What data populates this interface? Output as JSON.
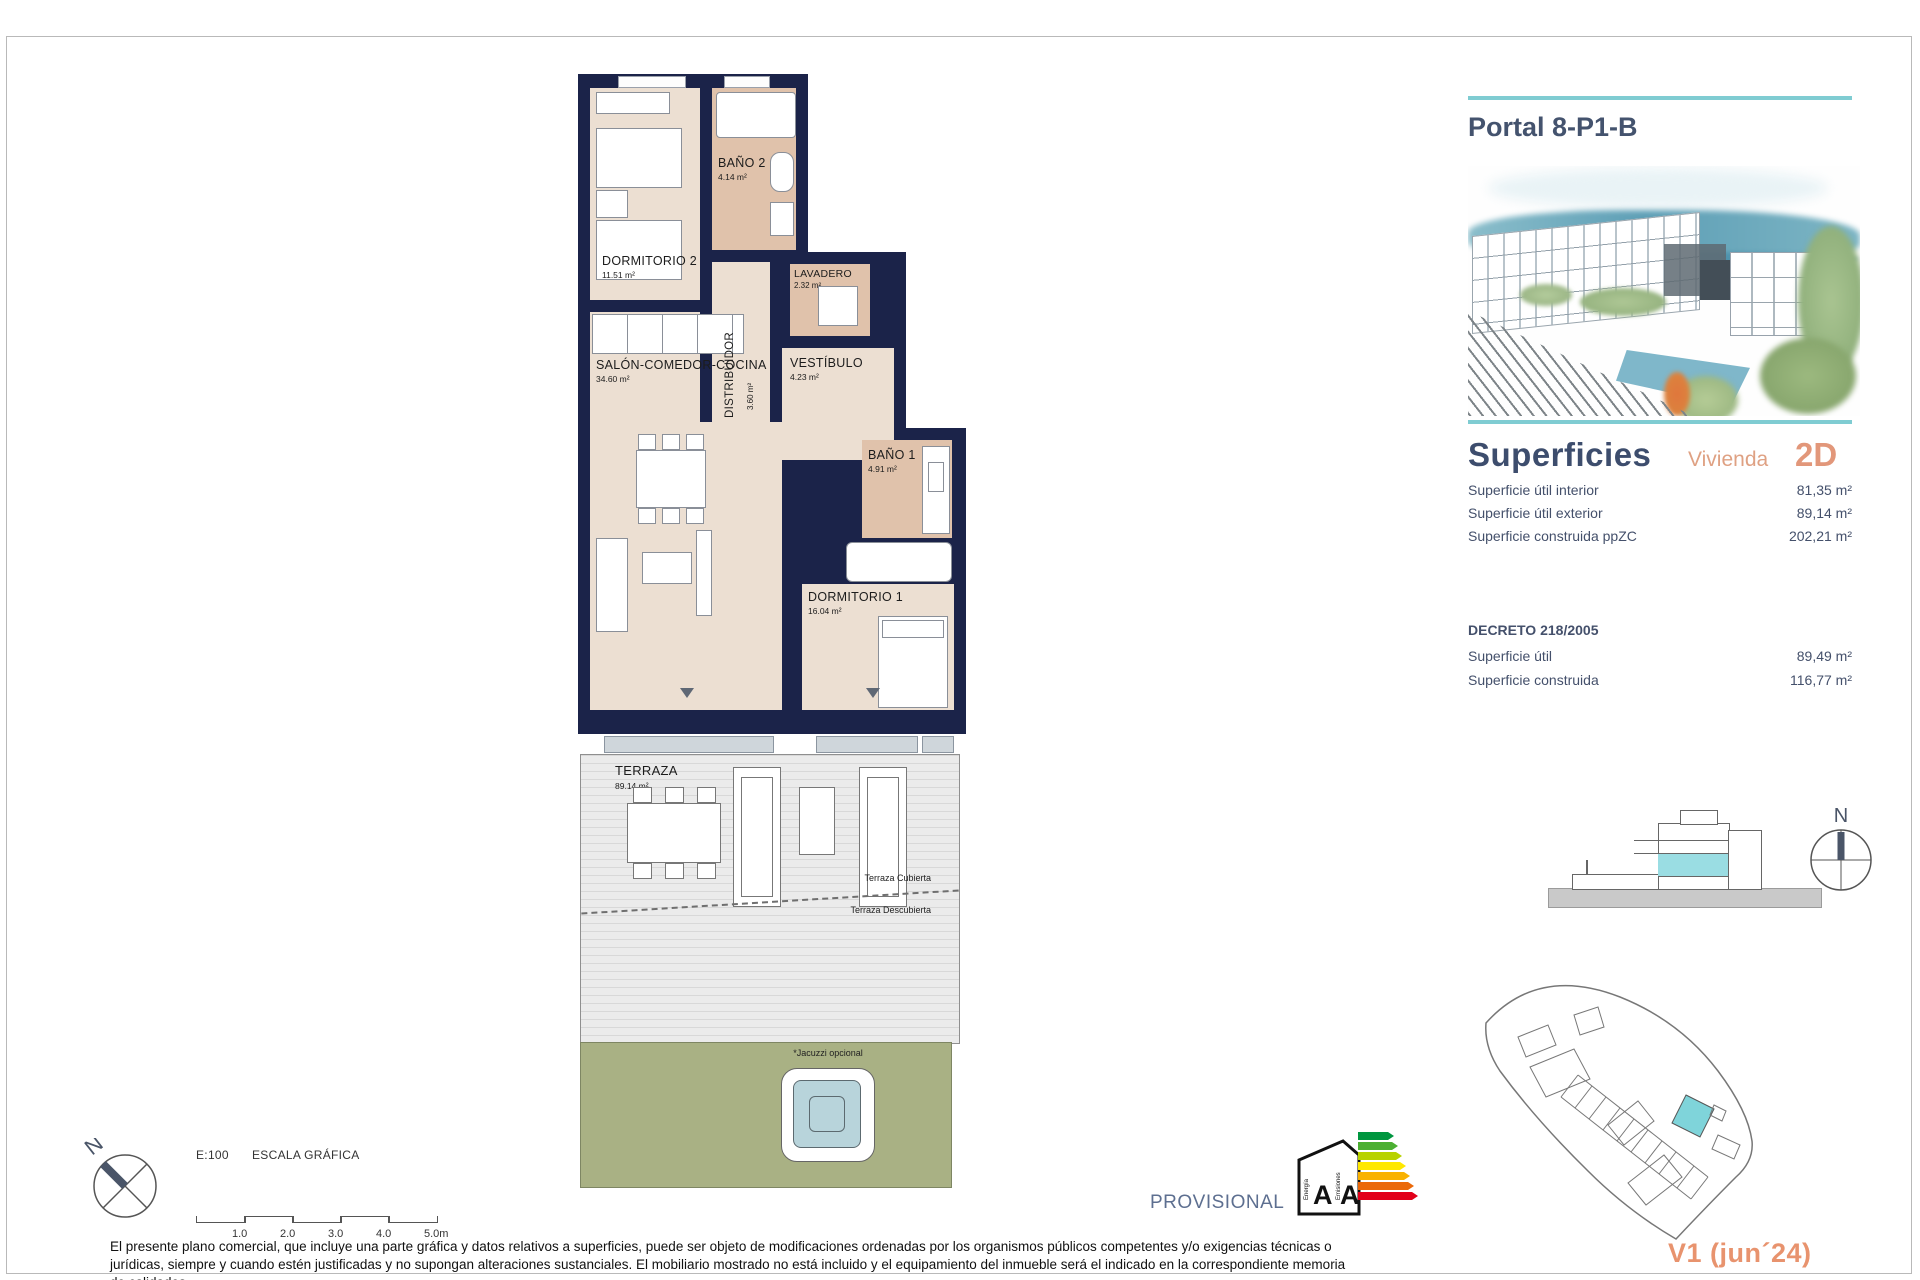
{
  "panel": {
    "title": "Portal 8-P1-B",
    "superficies": {
      "heading": "Superficies",
      "vivienda_label": "Vivienda",
      "vivienda_type": "2D",
      "rows": [
        {
          "label": "Superficie útil interior",
          "value": "81,35 m²"
        },
        {
          "label": "Superficie útil exterior",
          "value": "89,14 m²"
        },
        {
          "label": "Superficie construida ppZC",
          "value": "202,21 m²"
        }
      ]
    },
    "decreto": {
      "heading": "DECRETO 218/2005",
      "rows": [
        {
          "label": "Superficie útil",
          "value": "89,49 m²"
        },
        {
          "label": "Superficie construida",
          "value": "116,77 m²"
        }
      ]
    },
    "section_compass": "N",
    "version": "V1 (jun´24)"
  },
  "floorplan": {
    "rooms": {
      "dorm2": {
        "label": "DORMITORIO 2",
        "area": "11.51 m²"
      },
      "bano2": {
        "label": "BAÑO 2",
        "area": "4.14 m²"
      },
      "distribuidor": {
        "label": "DISTRIBUIDOR",
        "area": "3.60 m²"
      },
      "lavadero": {
        "label": "LAVADERO",
        "area": "2.32 m²"
      },
      "vestibulo": {
        "label": "VESTÍBULO",
        "area": "4.23 m²"
      },
      "salon": {
        "label": "SALÓN-COMEDOR-COCINA",
        "area": "34.60 m²"
      },
      "bano1": {
        "label": "BAÑO 1",
        "area": "4.91 m²"
      },
      "dorm1": {
        "label": "DORMITORIO 1",
        "area": "16.04 m²"
      },
      "terraza": {
        "label": "TERRAZA",
        "area": "89.14 m²"
      }
    },
    "terraza_cubierta": "Terraza Cubierta",
    "terraza_descubierta": "Terraza Descubierta",
    "jacuzzi_note": "*Jacuzzi opcional"
  },
  "compass": {
    "label": "N"
  },
  "scale": {
    "ratio": "E:100",
    "label": "ESCALA GRÁFICA",
    "ticks": [
      "1.0",
      "2.0",
      "3.0",
      "4.0",
      "5.0m"
    ]
  },
  "footer": {
    "provisional": "PROVISIONAL",
    "energy": {
      "letter1": "A",
      "letter2": "A",
      "axis1": "Energía",
      "axis2": "Emisiones"
    },
    "disclaimer": "El presente plano comercial, que incluye una parte gráfica y datos relativos a superficies, puede ser objeto de modificaciones ordenadas por los organismos públicos competentes y/o exigencias técnicas o jurídicas, siempre y cuando estén justificadas y no supongan alteraciones sustanciales. El mobiliario mostrado no está incluido y el equipamiento del inmueble será el indicado en la correspondiente memoria de calidades."
  },
  "colors": {
    "wall_navy": "#1b2349",
    "floor_beige": "#ecdfd2",
    "wet_room_tan": "#e0c2ab",
    "teal_accent": "#7fccd2",
    "orange_accent": "#e8936e",
    "heading_slate": "#3d4d6d",
    "garden_green": "#a9b184",
    "jacuzzi_blue": "#b8d4db"
  }
}
